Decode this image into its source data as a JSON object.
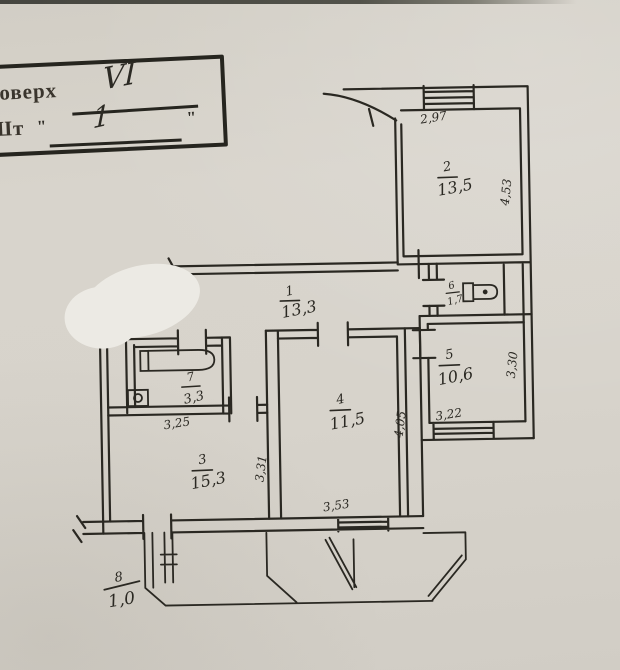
{
  "stamp": {
    "floor_label": "оверх",
    "floor_value": "VI",
    "unit_label": "Шт",
    "quote_open": "\"",
    "unit_value": "1",
    "quote_close": "\""
  },
  "rooms": [
    {
      "name": "corridor",
      "number": "1",
      "area": "13,3"
    },
    {
      "name": "room-2",
      "number": "2",
      "area": "13,5"
    },
    {
      "name": "room-3",
      "number": "3",
      "area": "15,3"
    },
    {
      "name": "room-4",
      "number": "4",
      "area": "11,5"
    },
    {
      "name": "room-5",
      "number": "5",
      "area": "10,6"
    },
    {
      "name": "wc",
      "number": "6",
      "area": "1,7"
    },
    {
      "name": "bathroom",
      "number": "7",
      "area": "3,3"
    },
    {
      "name": "balcony",
      "number": "8",
      "area": "1,0"
    }
  ],
  "dimensions": {
    "room2_top": "2,97",
    "room2_right": "4,53",
    "room5_bottom": "3,22",
    "room5_right": "3,30",
    "room4_bottom": "3,53",
    "room4_right": "4,05",
    "room3_top": "3,25",
    "room3_right": "3,31"
  },
  "colors": {
    "paper": "#d7d3cb",
    "ink": "#2a2822",
    "redaction": "#eceae4"
  }
}
